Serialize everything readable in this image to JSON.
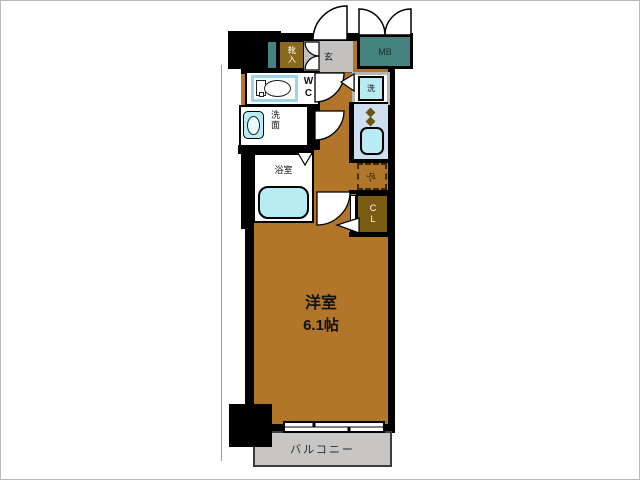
{
  "floorplan": {
    "main_room": {
      "name": "洋室",
      "size": "6.1帖"
    },
    "balcony": {
      "label": "バルコニー"
    },
    "entrance": {
      "label": "玄"
    },
    "shoe_cabinet": {
      "label": "靴入"
    },
    "meter_box": {
      "label": "MB"
    },
    "toilet": {
      "label": "WC"
    },
    "washroom": {
      "label": "洗面"
    },
    "bathroom": {
      "label": "浴室"
    },
    "washing_machine": {
      "label": "洗"
    },
    "refrigerator": {
      "label": "冷"
    },
    "closet": {
      "label": "CL"
    }
  },
  "colors": {
    "flooring": "#b1762a",
    "wall": "#000000",
    "entrance_floor": "#c2c1c0",
    "balcony_floor": "#c7c6c5",
    "meter_box": "#45837e",
    "shoe_cabinet": "#8b691c",
    "closet": "#7b5c13",
    "fixture_fill": "#b6ecf2",
    "kitchen_counter": "#ccdef0",
    "toilet_frame": "#9fd4e8",
    "washer_frame": "#b5b5b5"
  }
}
